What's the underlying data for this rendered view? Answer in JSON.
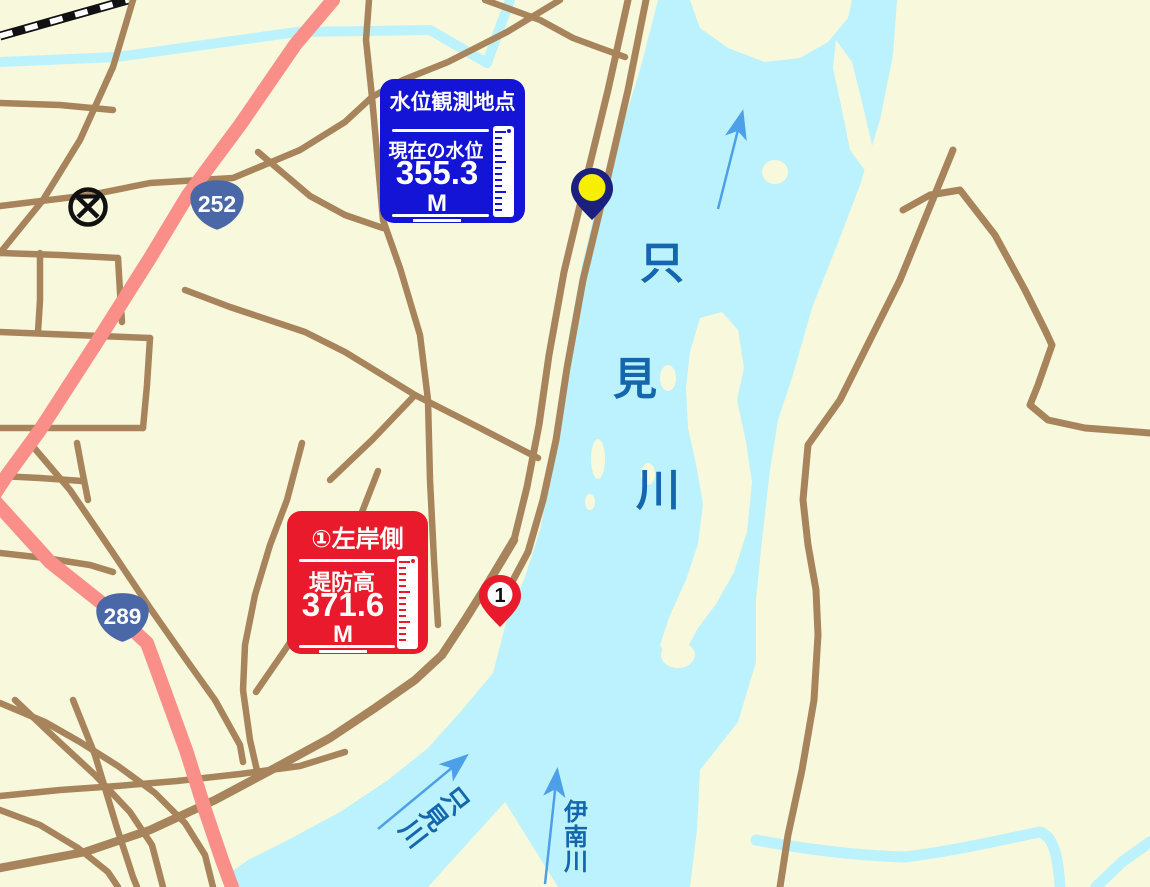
{
  "map": {
    "water_gauge_box": {
      "title": "水位観測地点",
      "label": "現在の水位",
      "value": "355.3",
      "unit": "M"
    },
    "levee_box": {
      "title": "①左岸側",
      "label": "堤防高",
      "value": "371.6",
      "unit": "M"
    },
    "route_badges": [
      {
        "number": "252"
      },
      {
        "number": "289"
      }
    ],
    "pins": [
      {
        "id": "water-level-pin",
        "color": "#f7ef00"
      },
      {
        "id": "levee-point-pin",
        "label": "1",
        "color": "#e81a2b"
      }
    ],
    "river_labels": {
      "main": {
        "chars": [
          "只",
          "見",
          "川"
        ]
      },
      "tadami_branch": {
        "chars": [
          "只",
          "見",
          "川"
        ]
      },
      "ina_branch": {
        "chars": [
          "伊",
          "南",
          "川"
        ]
      }
    },
    "map_symbols": [
      {
        "name": "police-station"
      }
    ],
    "colors": {
      "land": "#f8f9dc",
      "water": "#bcf2fd",
      "road": "#a8845c",
      "highway": "#f98f88",
      "route_badge": "#4a68a8",
      "gauge_box": "#1414d6",
      "levee_box": "#e81a2b",
      "river_label": "#1466af",
      "flow_arrow": "#4d9fe9",
      "pin_navy": "#1b2080",
      "pin_yellow": "#f7ef00"
    }
  }
}
